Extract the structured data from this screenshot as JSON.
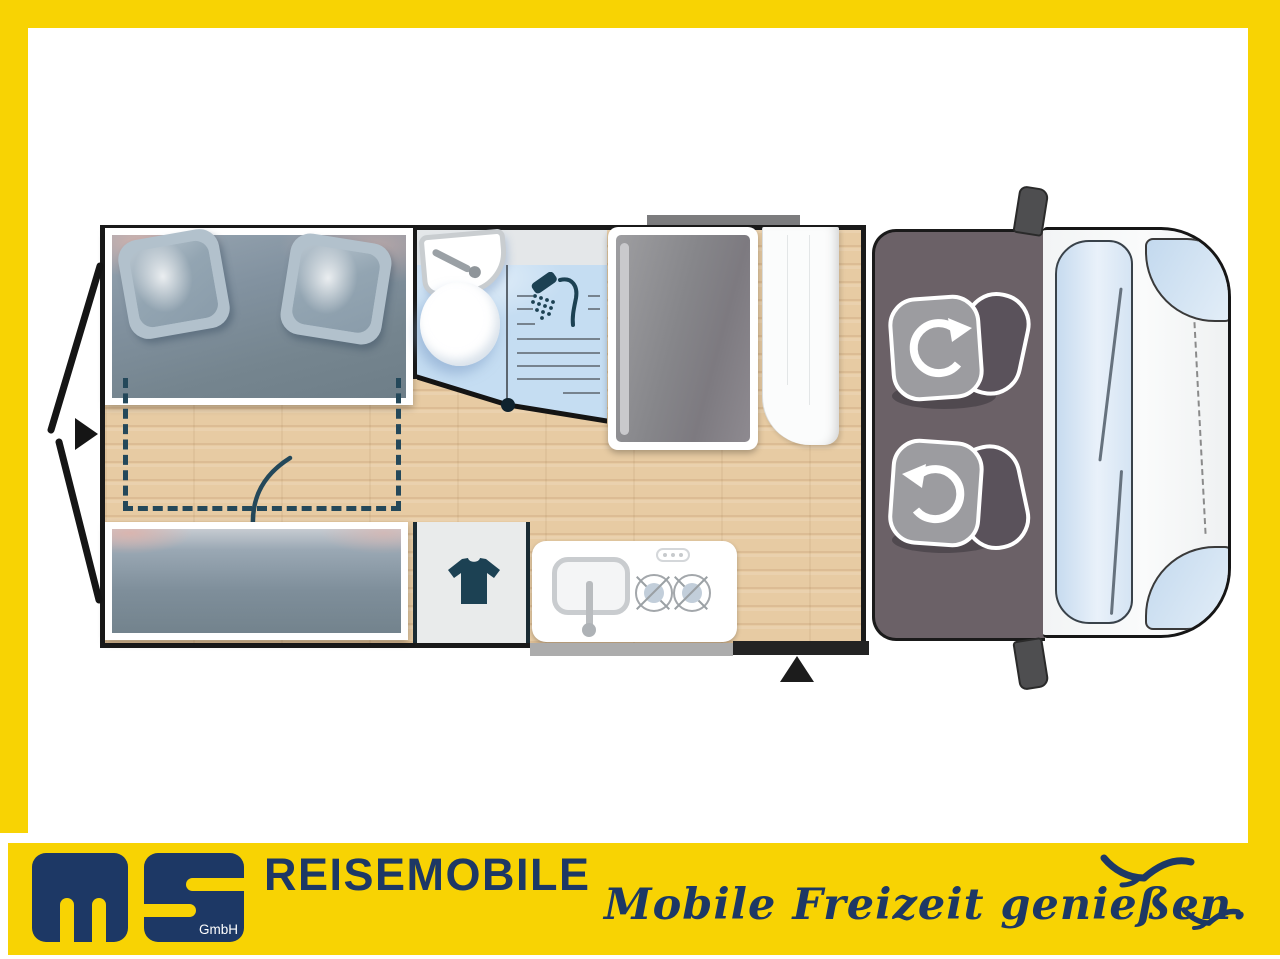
{
  "window": {
    "width": 1280,
    "height": 959
  },
  "brand": {
    "logo_text": "ms",
    "logo_suffix": "GmbH",
    "company_line": "REISEMOBILE",
    "slogan": "Mobile Freizeit genießen.",
    "colors": {
      "yellow": "#F8D303",
      "navy": "#1D3865",
      "white": "#FFFFFF"
    }
  },
  "floorplan": {
    "type": "camper-van-top-view",
    "areas": {
      "rear_bed": "double-bed-with-two-pillows",
      "bed_extension": "dashed-fold-out-area-with-arrow",
      "lower_bench": "bench-bed",
      "bathroom": "toilet-washbasin-shower",
      "wardrobe": "clothes-cabinet",
      "kitchen": "sink-and-two-burner-hob",
      "tall_cabinet": "fridge-column",
      "cab": "two-swivel-seats",
      "entry": "sliding-door-with-step",
      "rear": "double-rear-doors-open"
    },
    "icons": [
      "rear-doors-arrow-icon",
      "fold-down-arrow-icon",
      "washbasin-icon",
      "toilet-icon",
      "shower-head-icon",
      "tshirt-icon",
      "kitchen-sink-icon",
      "burner-icon",
      "stove-knobs-icon",
      "swivel-arrow-icon",
      "entry-triangle-icon",
      "mirror-icon",
      "seagull-icon"
    ],
    "colors": {
      "wood_floor": "#E7CBA3",
      "mattress": "#8292A0",
      "pillow": "#B2C1CC",
      "bathroom_floor": "#C5DDF2",
      "counter": "#E4E7E9",
      "accent_teal": "#1C4153",
      "dash_teal": "#24485A",
      "cab_floor": "#6B6167",
      "seat_gray": "#9C9CA0",
      "backrest_gray": "#5A525B",
      "van_body": "#F7F8F8",
      "windshield": "#CFE0F1",
      "outline": "#1A1A1A"
    }
  }
}
